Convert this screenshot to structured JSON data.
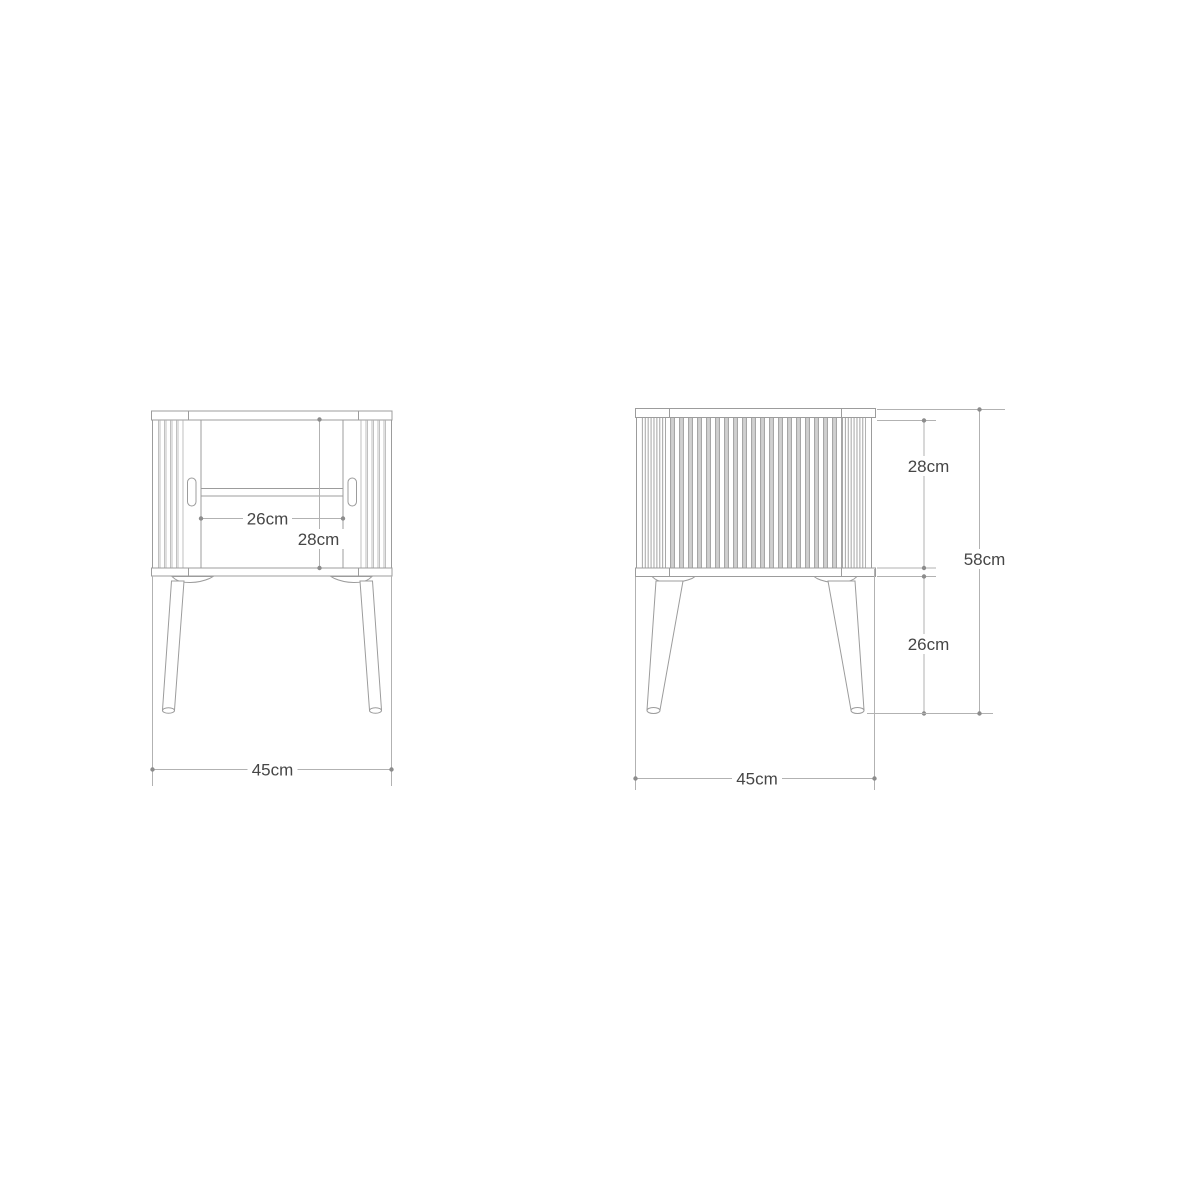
{
  "drawing": {
    "front_view": {
      "opening_width_label": "26cm",
      "interior_height_label": "28cm",
      "overall_width_label": "45cm"
    },
    "side_view": {
      "body_height_label": "28cm",
      "overall_height_label": "58cm",
      "leg_height_label": "26cm",
      "depth_label": "45cm"
    }
  }
}
